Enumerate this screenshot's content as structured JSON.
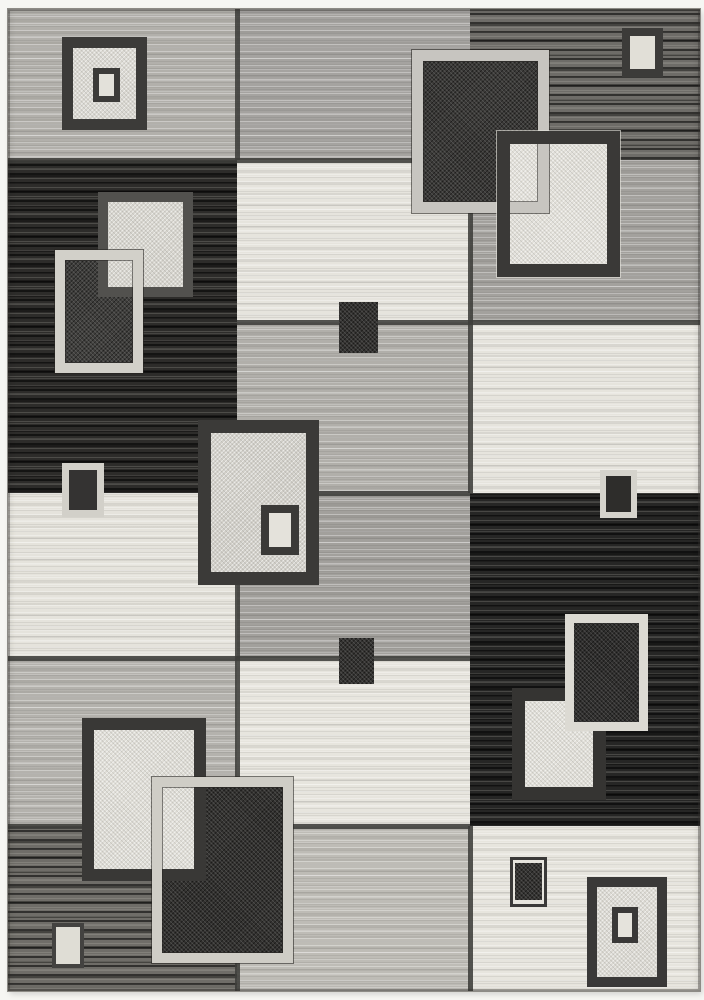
{
  "description": "Product photo of a modern geometric area rug; patchwork grid of grey, charcoal, black and cream blocks overlaid with concentric and overlapping square motifs; white page margin around rug.",
  "page": {
    "background": "#f6f6f3"
  },
  "palette": {
    "cream_white": "#e7e5de",
    "light_gray": "#b4b2ad",
    "medium_gray": "#a3a19d",
    "peppered_gray": "#6f6d68",
    "charcoal_black": "#2c2b29",
    "dark_border": "#3a3937",
    "light_border": "#d2d0c9"
  },
  "rug": {
    "x": 8,
    "y": 9,
    "width": 692,
    "height": 982,
    "line_color": "#3e3d3a",
    "patches": [
      {
        "name": "patch-top-left-lightgray",
        "x": 0,
        "y": 0,
        "w": 229,
        "h": 151,
        "c": "#b2b0ab",
        "tx": "h"
      },
      {
        "name": "patch-top-mid-gray",
        "x": 229,
        "y": 0,
        "w": 233,
        "h": 151,
        "c": "#a5a3a0",
        "tx": "h"
      },
      {
        "name": "patch-top-right-charcoal",
        "x": 462,
        "y": 0,
        "w": 230,
        "h": 151,
        "c": "#6e6c68",
        "tx": "hd"
      },
      {
        "name": "patch-left-black",
        "x": 0,
        "y": 151,
        "w": 229,
        "h": 333,
        "c": "#2d2c2a",
        "tx": "hd"
      },
      {
        "name": "patch-mid-white-upper",
        "x": 229,
        "y": 151,
        "w": 233,
        "h": 162,
        "c": "#e6e4dd",
        "tx": "h"
      },
      {
        "name": "patch-right-gray-upper",
        "x": 462,
        "y": 151,
        "w": 230,
        "h": 162,
        "c": "#a3a19d",
        "tx": "h"
      },
      {
        "name": "patch-mid-gray-middle",
        "x": 229,
        "y": 313,
        "w": 233,
        "h": 171,
        "c": "#b1afaa",
        "tx": "h"
      },
      {
        "name": "patch-right-white-middle",
        "x": 462,
        "y": 313,
        "w": 230,
        "h": 171,
        "c": "#e6e4dd",
        "tx": "h"
      },
      {
        "name": "patch-left-white-middle",
        "x": 0,
        "y": 484,
        "w": 229,
        "h": 165,
        "c": "#e5e3dc",
        "tx": "h"
      },
      {
        "name": "patch-mid-gray-lower",
        "x": 229,
        "y": 484,
        "w": 233,
        "h": 165,
        "c": "#a2a09c",
        "tx": "h"
      },
      {
        "name": "patch-right-black",
        "x": 462,
        "y": 484,
        "w": 230,
        "h": 333,
        "c": "#262625",
        "tx": "hd"
      },
      {
        "name": "patch-left-lightgray-lower",
        "x": 0,
        "y": 649,
        "w": 229,
        "h": 168,
        "c": "#b4b2ad",
        "tx": "h"
      },
      {
        "name": "patch-mid-white-lower",
        "x": 229,
        "y": 649,
        "w": 233,
        "h": 168,
        "c": "#e7e5de",
        "tx": "h"
      },
      {
        "name": "patch-left-darkgray-bottom",
        "x": 0,
        "y": 817,
        "w": 229,
        "h": 165,
        "c": "#6f6d68",
        "tx": "hd"
      },
      {
        "name": "patch-mid-lightgray-bottom",
        "x": 229,
        "y": 817,
        "w": 233,
        "h": 165,
        "c": "#bebcb6",
        "tx": "h"
      },
      {
        "name": "patch-right-white-bottom",
        "x": 462,
        "y": 817,
        "w": 230,
        "h": 165,
        "c": "#e7e5de",
        "tx": "h"
      }
    ],
    "gridlines": [
      {
        "name": "gridline-h-160",
        "x": 0,
        "y": 149,
        "w": 462,
        "h": 5
      },
      {
        "name": "gridline-h-322",
        "x": 229,
        "y": 311,
        "w": 463,
        "h": 5
      },
      {
        "name": "gridline-h-493",
        "x": 229,
        "y": 482,
        "w": 233,
        "h": 5
      },
      {
        "name": "gridline-h-658",
        "x": 0,
        "y": 647,
        "w": 462,
        "h": 5
      },
      {
        "name": "gridline-h-826",
        "x": 0,
        "y": 815,
        "w": 462,
        "h": 5
      },
      {
        "name": "gridline-v-237-top",
        "x": 227,
        "y": 0,
        "w": 5,
        "h": 151
      },
      {
        "name": "gridline-v-237-bottom",
        "x": 227,
        "y": 484,
        "w": 5,
        "h": 498
      },
      {
        "name": "gridline-v-470-upper",
        "x": 460,
        "y": 151,
        "w": 5,
        "h": 333
      },
      {
        "name": "gridline-v-470-bottom",
        "x": 460,
        "y": 817,
        "w": 5,
        "h": 165
      }
    ],
    "squares": [
      {
        "name": "square-top-left-outer",
        "kind": "full",
        "x": 54,
        "y": 28,
        "w": 85,
        "h": 93,
        "bw": 11,
        "bc": "#3c3b39",
        "fc": "#dad8d1",
        "tx": "sp"
      },
      {
        "name": "square-top-left-inner",
        "kind": "full",
        "x": 85,
        "y": 59,
        "w": 27,
        "h": 34,
        "bw": 6,
        "bc": "#3c3b39",
        "fc": "#e3e1da"
      },
      {
        "name": "square-left-black-b-fill",
        "kind": "fill",
        "x": 47,
        "y": 241,
        "w": 88,
        "h": 123,
        "fc": "#403f3d",
        "tx": "spd"
      },
      {
        "name": "square-left-black-a",
        "kind": "full",
        "x": 90,
        "y": 183,
        "w": 95,
        "h": 105,
        "bw": 10,
        "bc": "#52514e",
        "fc": "#d6d4cd",
        "tx": "sp"
      },
      {
        "name": "square-left-black-b-frame",
        "kind": "frame",
        "x": 47,
        "y": 241,
        "w": 88,
        "h": 123,
        "bw": 10,
        "bc": "#d2d0c9",
        "edge": "dark"
      },
      {
        "name": "square-small-left-mid",
        "kind": "full",
        "x": 54,
        "y": 454,
        "w": 42,
        "h": 54,
        "bw": 7,
        "bc": "#d2d0c9",
        "fc": "#343332"
      },
      {
        "name": "square-center-outer",
        "kind": "full",
        "x": 190,
        "y": 411,
        "w": 121,
        "h": 165,
        "bw": 13,
        "bc": "#3b3a38",
        "fc": "#d2d0c9",
        "tx": "sp"
      },
      {
        "name": "square-center-inner",
        "kind": "full",
        "x": 253,
        "y": 496,
        "w": 38,
        "h": 50,
        "bw": 8,
        "bc": "#3b3a38",
        "fc": "#e4e2db"
      },
      {
        "name": "square-small-mid-upper",
        "kind": "fill",
        "x": 331,
        "y": 293,
        "w": 39,
        "h": 51,
        "fc": "#343331",
        "tx": "spd"
      },
      {
        "name": "square-small-mid-lower",
        "kind": "fill",
        "x": 331,
        "y": 629,
        "w": 35,
        "h": 46,
        "fc": "#343331",
        "tx": "spd"
      },
      {
        "name": "square-top-right-a-fill",
        "kind": "fill",
        "x": 404,
        "y": 41,
        "w": 137,
        "h": 163,
        "fc": "#3a3937",
        "tx": "spd"
      },
      {
        "name": "square-top-right-b-fill",
        "kind": "fill",
        "x": 489,
        "y": 122,
        "w": 123,
        "h": 146,
        "fc": "#e2e0d9",
        "tx": "sp"
      },
      {
        "name": "square-top-right-a-frame",
        "kind": "frame",
        "x": 404,
        "y": 41,
        "w": 137,
        "h": 163,
        "bw": 11,
        "bc": "#c7c5c0",
        "edge": "dark"
      },
      {
        "name": "square-top-right-b-frame",
        "kind": "frame",
        "x": 489,
        "y": 122,
        "w": 123,
        "h": 146,
        "bw": 13,
        "bc": "#3a3937",
        "edge": "light"
      },
      {
        "name": "square-small-top-right",
        "kind": "full",
        "x": 614,
        "y": 19,
        "w": 41,
        "h": 49,
        "bw": 8,
        "bc": "#3c3b39",
        "fc": "#e1dfd7"
      },
      {
        "name": "square-small-right-mid",
        "kind": "full",
        "x": 592,
        "y": 461,
        "w": 37,
        "h": 48,
        "bw": 6,
        "bc": "#d5d3cc",
        "fc": "#2e2d2b"
      },
      {
        "name": "square-right-black-white",
        "kind": "full",
        "x": 504,
        "y": 679,
        "w": 94,
        "h": 112,
        "bw": 13,
        "bc": "#353432",
        "fc": "#e1dfd8",
        "tx": "sp"
      },
      {
        "name": "square-right-black-dark-fill",
        "kind": "fill",
        "x": 557,
        "y": 605,
        "w": 83,
        "h": 117,
        "fc": "#302f2e",
        "tx": "spd"
      },
      {
        "name": "square-right-black-dark-frame",
        "kind": "frame",
        "x": 557,
        "y": 605,
        "w": 83,
        "h": 117,
        "bw": 9,
        "bc": "#dcdad3"
      },
      {
        "name": "square-bottom-left-dark-fill",
        "kind": "fill",
        "x": 144,
        "y": 768,
        "w": 141,
        "h": 186,
        "fc": "#333230",
        "tx": "spd"
      },
      {
        "name": "square-bottom-left-cream",
        "kind": "full",
        "x": 74,
        "y": 709,
        "w": 124,
        "h": 163,
        "bw": 12,
        "bc": "#393836",
        "fc": "#dfddd6",
        "tx": "sp"
      },
      {
        "name": "square-bottom-left-dark-frame",
        "kind": "frame",
        "x": 144,
        "y": 768,
        "w": 141,
        "h": 186,
        "bw": 10,
        "bc": "#cfcdc6",
        "edge": "dark"
      },
      {
        "name": "square-small-bottom-left",
        "kind": "full",
        "x": 44,
        "y": 914,
        "w": 32,
        "h": 45,
        "bw": 4,
        "bc": "#434240",
        "fc": "#dfddd5"
      },
      {
        "name": "square-small-bottom-mid",
        "kind": "full",
        "x": 502,
        "y": 848,
        "w": 37,
        "h": 50,
        "bw": 3,
        "bc": "#3a3938",
        "fc": "#e6e4dd"
      },
      {
        "name": "square-small-bottom-mid-fill",
        "kind": "fill",
        "x": 507,
        "y": 854,
        "w": 27,
        "h": 37,
        "fc": "#343331",
        "tx": "spd"
      },
      {
        "name": "square-bottom-right-outer",
        "kind": "full",
        "x": 579,
        "y": 868,
        "w": 80,
        "h": 110,
        "bw": 10,
        "bc": "#3a3938",
        "fc": "#dcdad3",
        "tx": "sp"
      },
      {
        "name": "square-bottom-right-inner",
        "kind": "full",
        "x": 604,
        "y": 898,
        "w": 26,
        "h": 36,
        "bw": 6,
        "bc": "#3a3938",
        "fc": "#e5e3dc"
      }
    ]
  }
}
